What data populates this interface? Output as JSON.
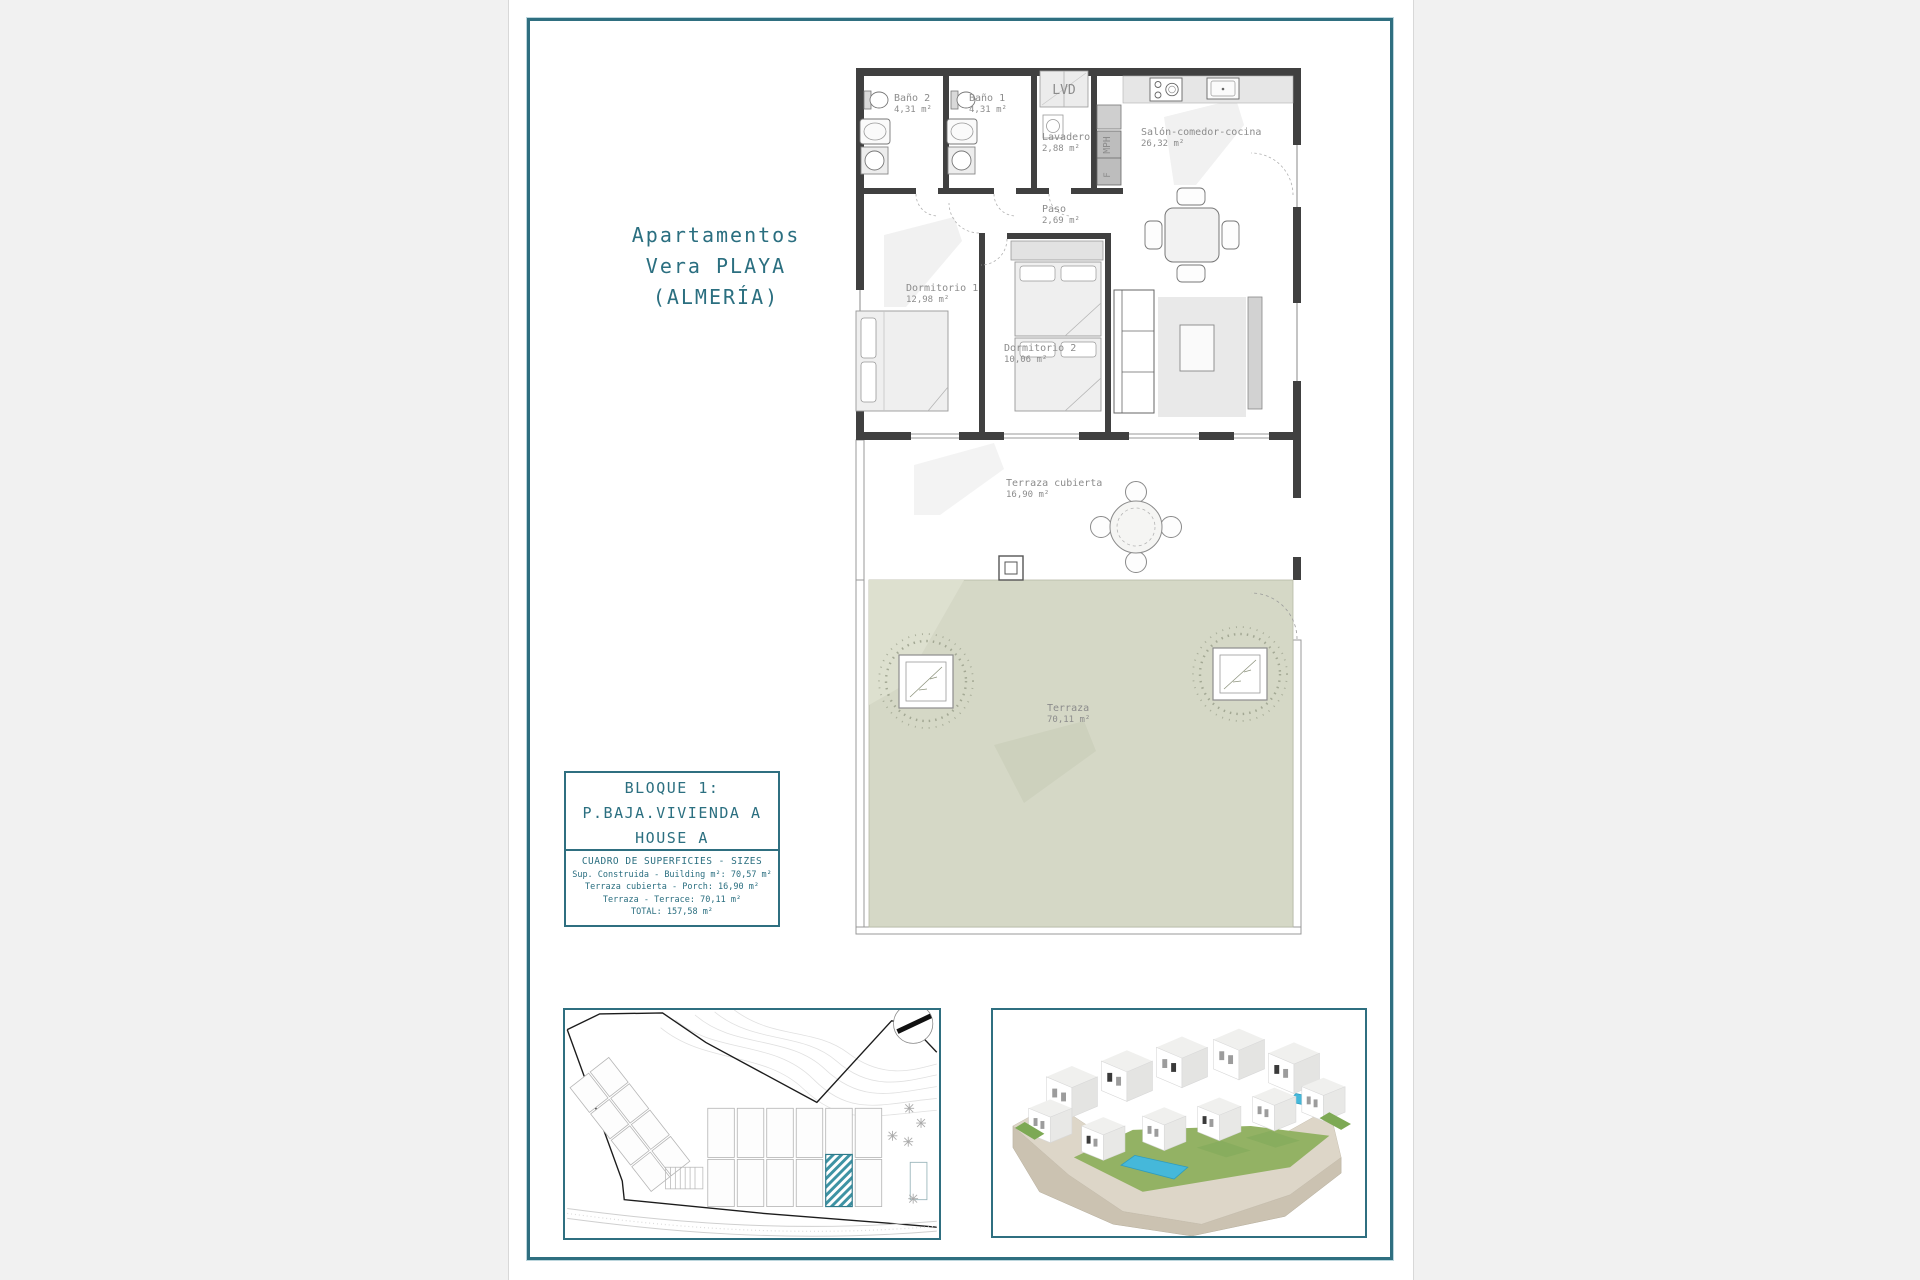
{
  "page": {
    "title_lines": [
      "Apartamentos",
      "Vera PLAYA",
      "(ALMERÍA)"
    ],
    "accent_color": "#2f6f80"
  },
  "floor_plan": {
    "rooms": [
      {
        "label": "Baño 2",
        "area": "4,31 m²"
      },
      {
        "label": "Baño 1",
        "area": "4,31 m²"
      },
      {
        "label": "LVD",
        "area": ""
      },
      {
        "label": "Lavadero",
        "area": "2,88 m²"
      },
      {
        "label": "MPH",
        "area": ""
      },
      {
        "label": "F",
        "area": ""
      },
      {
        "label": "Salón-comedor-cocina",
        "area": "26,32 m²"
      },
      {
        "label": "Paso",
        "area": "2,69 m²"
      },
      {
        "label": "Dormitorio 1",
        "area": "12,98 m²"
      },
      {
        "label": "Dormitorio 2",
        "area": "10,06 m²"
      },
      {
        "label": "Terraza cubierta",
        "area": "16,90 m²"
      },
      {
        "label": "Terraza",
        "area": "70,11 m²"
      }
    ],
    "colors": {
      "terrace_green": "#d5d8c6",
      "walls": "#404040"
    }
  },
  "unit_info": {
    "block_lines": [
      "BLOQUE 1:",
      "P.BAJA.VIVIENDA A",
      "HOUSE A"
    ],
    "sizes": {
      "header": "CUADRO DE SUPERFICIES  - SIZES",
      "rows": [
        "Sup. Construida  - Building m²: 70,57 m²",
        "Terraza cubierta  - Porch: 16,90 m²",
        "Terraza - Terrace: 70,11 m²",
        "TOTAL:  157,58 m²"
      ]
    }
  },
  "site_plan": {
    "highlight_color": "#3e93a4"
  },
  "render": {
    "pool_color": "#45b8da",
    "lawn_color": "#93b264"
  }
}
